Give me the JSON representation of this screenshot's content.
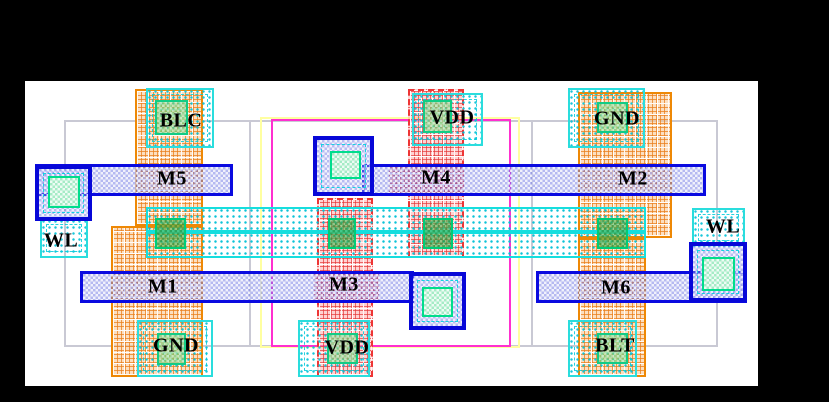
{
  "figure": {
    "kind": "ic-layout-diagram",
    "cell": "6T SRAM cell layout"
  },
  "labels": {
    "blc": "BLC",
    "vdd_top": "VDD",
    "gnd_top": "GND",
    "m5": "M5",
    "m4": "M4",
    "m2": "M2",
    "wl_left": "WL",
    "wl_right": "WL",
    "m1": "M1",
    "m3": "M3",
    "m6": "M6",
    "gnd_bottom": "GND",
    "vdd_bottom": "VDD",
    "blt": "BLT"
  },
  "palette": {
    "background": "#000000",
    "canvas": "#ffffff",
    "poly_gate_blue": "#0a0ae0",
    "metal_cyan": "#16dede",
    "ndiff_orange": "#ee8805",
    "pdiff_red": "#ee3535",
    "contact_green": "#00cc77",
    "nwell_magenta": "#ff2fd0",
    "select_yellow": "#ffffa0",
    "boundary_gray": "#c9c9d4"
  }
}
